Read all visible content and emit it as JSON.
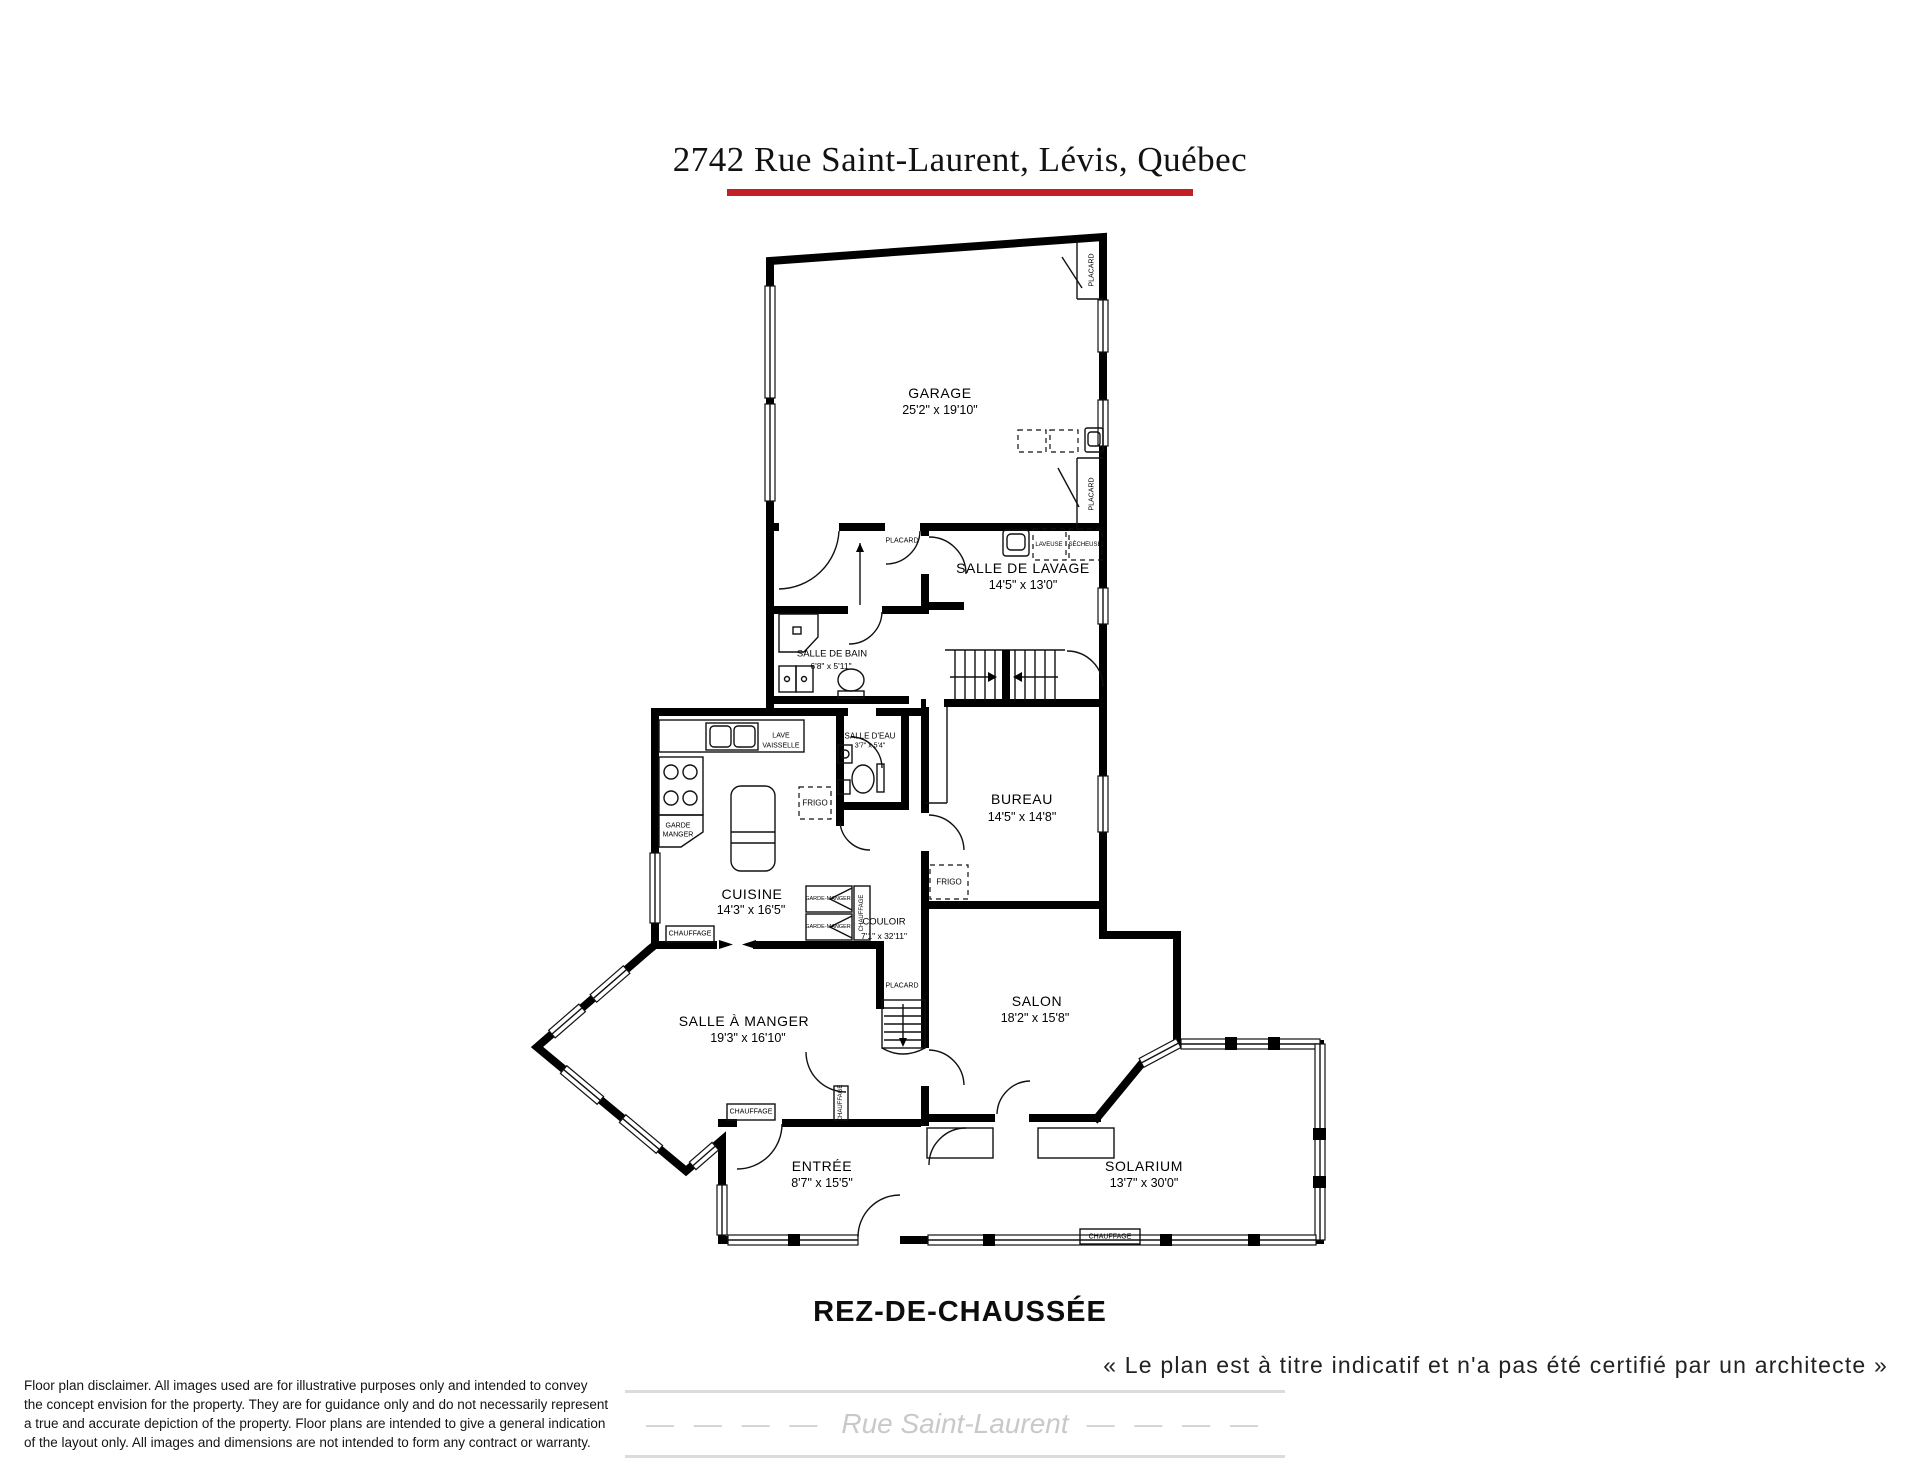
{
  "title": "2742 Rue Saint-Laurent, Lévis, Québec",
  "floor_label": "REZ-DE-CHAUSSÉE",
  "quote": "« Le plan est à titre indicatif et n'a pas été certifié par un architecte »",
  "street": {
    "name": "Rue Saint-Laurent",
    "dashes_left": "—  —  —  —",
    "dashes_right": "—  —  —  —"
  },
  "disclaimer": "Floor plan disclaimer. All images used are for illustrative purposes only and intended to convey the concept envision for the property. They are for guidance only and do not necessarily represent a true and accurate depiction of the property. Floor plans are intended to give a general indication of the layout only. All images and dimensions are not intended to form any contract or warranty.",
  "colors": {
    "accent_red": "#c32026",
    "wall_black": "#000000",
    "street_gray": "#c9c9c9"
  },
  "rooms": {
    "garage": {
      "name": "GARAGE",
      "dims": "25'2\" x 19'10\""
    },
    "lavage": {
      "name": "SALLE DE LAVAGE",
      "dims": "14'5\" x 13'0\""
    },
    "bain": {
      "name": "SALLE DE BAIN",
      "dims": "6'8\" x 5'11\""
    },
    "eau": {
      "name": "SALLE D'EAU",
      "dims": "3'7\" x 5'4\""
    },
    "bureau": {
      "name": "BUREAU",
      "dims": "14'5\" x 14'8\""
    },
    "cuisine": {
      "name": "CUISINE",
      "dims": "14'3\" x 16'5\""
    },
    "couloir": {
      "name": "COULOIR",
      "dims": "7'1\" x 32'11\""
    },
    "manger": {
      "name": "SALLE À MANGER",
      "dims": "19'3\" x 16'10\""
    },
    "salon": {
      "name": "SALON",
      "dims": "18'2\" x 15'8\""
    },
    "entree": {
      "name": "ENTRÉE",
      "dims": "8'7\" x 15'5\""
    },
    "solarium": {
      "name": "SOLARIUM",
      "dims": "13'7\" x 30'0\""
    }
  },
  "labels": {
    "placard": "PLACARD",
    "chauffage": "CHAUFFAGE",
    "frigo": "FRIGO",
    "laveuse": "LAVEUSE",
    "secheuse": "SÉCHEUSE",
    "lave": "LAVE",
    "vaisselle": "VAISSELLE",
    "garde": "GARDE",
    "manger": "MANGER",
    "garde_manger": "GARDE-MANGER"
  }
}
